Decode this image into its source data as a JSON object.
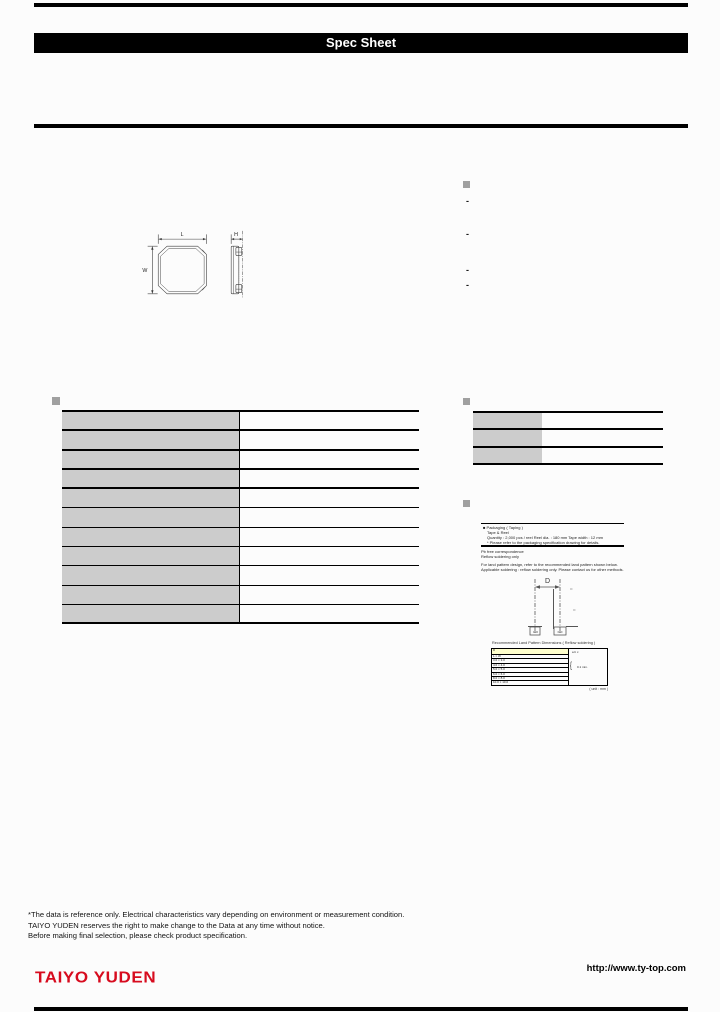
{
  "header": {
    "top_title": "Spec Sheet"
  },
  "drawing": {
    "dim_l": "L",
    "dim_w": "W",
    "dim_h": "H"
  },
  "features": {
    "items": [
      "-",
      "-",
      "-",
      "-"
    ]
  },
  "spec_table": {
    "rows": [
      {
        "label": "",
        "value": ""
      },
      {
        "label": "",
        "value": ""
      },
      {
        "label": "",
        "value": ""
      },
      {
        "label": "",
        "value": ""
      },
      {
        "label": "",
        "value": ""
      },
      {
        "label": "",
        "value": ""
      },
      {
        "label": "",
        "value": ""
      },
      {
        "label": "",
        "value": ""
      },
      {
        "label": "",
        "value": ""
      },
      {
        "label": "",
        "value": ""
      },
      {
        "label": "",
        "value": ""
      }
    ]
  },
  "info_table": {
    "rows": [
      {
        "label": "",
        "value": ""
      },
      {
        "label": "",
        "value": ""
      },
      {
        "label": "",
        "value": ""
      }
    ]
  },
  "packaging": {
    "box": {
      "title": "■  Packaging ( Taping )",
      "line1": "Tape & Reel",
      "line2": "Quantity : 2,000 pcs / reel   Reel dia. : 180 mm   Tape width : 12 mm",
      "line3": "* Please refer to the packaging specification drawing for details."
    },
    "notes": [
      "Pb free correspondence",
      "Reflow soldering only",
      "For land pattern design, refer to the recommended land pattern shown below.",
      "Applicable soldering : reflow soldering only. Please contact us for other methods."
    ],
    "land": {
      "dim_label": "D",
      "caption": "Recommended Land Pattern Dimensions ( Reflow soldering )",
      "rows": [
        "D",
        "L × W",
        "3.0 × 3.0",
        "4.0 × 4.0",
        "5.0 × 5.0",
        "6.0 × 6.0",
        "8.0 × 8.0",
        "10.0 × 10.0"
      ],
      "head_values": "a    b    c",
      "brace": "{",
      "merged_value": "0.1 min.",
      "unit_note": "( unit : mm )"
    }
  },
  "footer": {
    "notes": [
      "*The data is reference only. Electrical characteristics vary depending on environment or measurement condition.",
      "TAIYO YUDEN reserves the right to make change to the Data at any time without notice.",
      "Before making final selection, please check product specification."
    ],
    "brand": "TAIYO YUDEN",
    "url": "http://www.ty-top.com"
  },
  "colors": {
    "accent_red": "#d70b1e",
    "table_label_bg": "#cccccc",
    "highlight_yellow": "#ffffcc",
    "bullet_gray": "#a0a0a0"
  }
}
